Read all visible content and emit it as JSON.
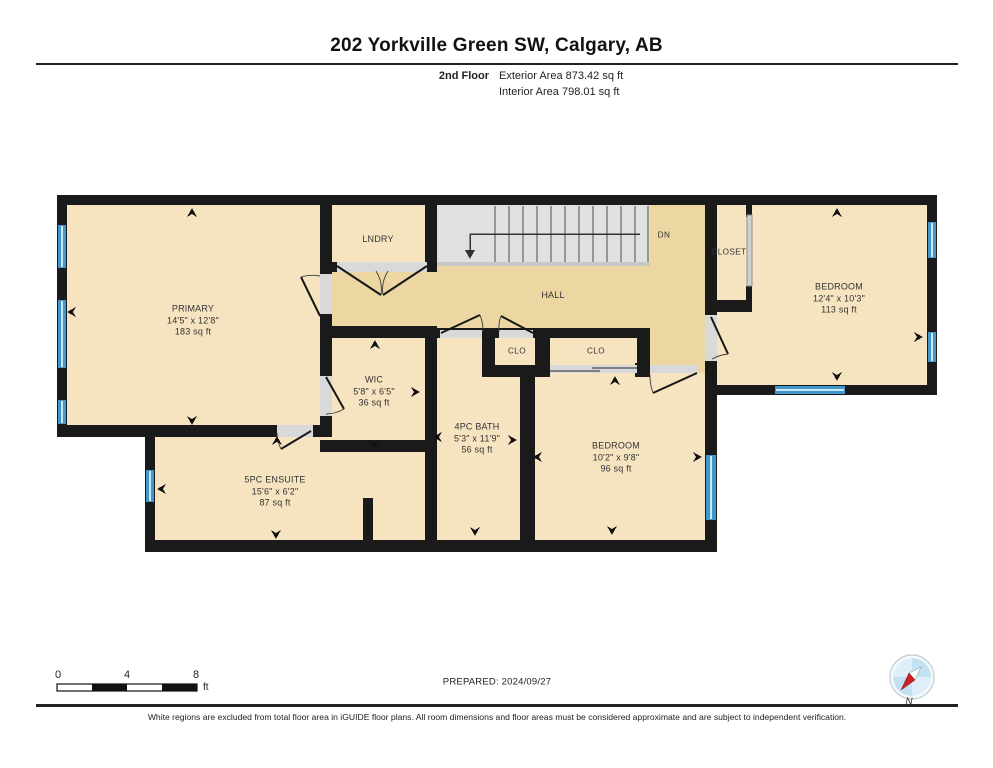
{
  "page": {
    "title": "202 Yorkville Green SW, Calgary, AB",
    "floor_label": "2nd Floor",
    "exterior_area": "Exterior Area 873.42 sq ft",
    "interior_area": "Interior Area 798.01 sq ft",
    "prepared": "PREPARED: 2024/09/27",
    "disclaimer": "White regions are excluded from total floor area in iGUIDE floor plans. All room dimensions and floor areas must be considered approximate and are subject to independent verification.",
    "compass_label": "N",
    "scale": {
      "t0": "0",
      "t4": "4",
      "t8": "8",
      "unit": "ft"
    }
  },
  "rooms": {
    "primary": {
      "name": "PRIMARY",
      "dims": "14'5\" x 12'8\"",
      "area": "183 sq ft"
    },
    "lndry": {
      "name": "LNDRY"
    },
    "hall": {
      "name": "HALL"
    },
    "dn": {
      "name": "DN"
    },
    "closet": {
      "name": "CLOSET"
    },
    "bedroom_ne": {
      "name": "BEDROOM",
      "dims": "12'4\" x 10'3\"",
      "area": "113 sq ft"
    },
    "wic": {
      "name": "WIC",
      "dims": "5'8\" x 6'5\"",
      "area": "36 sq ft"
    },
    "clo_small": {
      "name": "CLO"
    },
    "clo_large": {
      "name": "CLO"
    },
    "bath": {
      "name": "4PC BATH",
      "dims": "5'3\" x 11'9\"",
      "area": "56 sq ft"
    },
    "bedroom_s": {
      "name": "BEDROOM",
      "dims": "10'2\" x 9'8\"",
      "area": "96 sq ft"
    },
    "ensuite": {
      "name": "5PC ENSUITE",
      "dims": "15'6\" x 6'2\"",
      "area": "87 sq ft"
    }
  },
  "colors": {
    "wall": "#1a1a1a",
    "room_fill": "#f6e4c1",
    "hall_fill": "#ecd6a2",
    "stairs_fill": "#e0e0e0",
    "window_outer": "#3f97cb",
    "window_inner": "#c9e8f6",
    "door_opening": "#d9d9d9",
    "compass_red": "#cc1f1f",
    "compass_blue": "#b9ddf0"
  }
}
